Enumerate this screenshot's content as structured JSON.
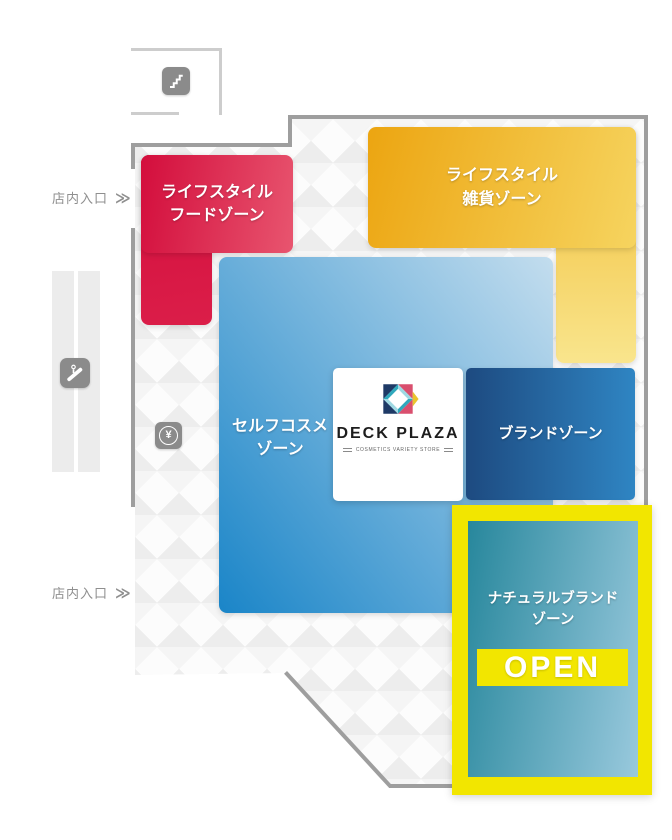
{
  "map": {
    "title_implicit": "DECK PLAZA floor map",
    "colors": {
      "wall": "#9e9e9e",
      "room_outline": "#cdcdcd",
      "highlight_yellow": "#f2e600",
      "food_from": "#d30d3c",
      "food_to": "#e8556f",
      "goods_from": "#eca511",
      "goods_to": "#f9e58d",
      "cosme_from": "#1a85c8",
      "cosme_to": "#c3ddee",
      "brand_from": "#1d4a80",
      "brand_to": "#2f85c3",
      "natural_from": "#27879c",
      "natural_to": "#99c9dd"
    },
    "entrance_top": {
      "label": "店内入口",
      "arrow": "≫"
    },
    "entrance_bottom": {
      "label": "店内入口",
      "arrow": "≫"
    },
    "icons": {
      "stairs": "stairs-icon",
      "escalator": "escalator-icon",
      "cash_register_symbol": "¥"
    },
    "zones": {
      "lifestyle_food": {
        "line1": "ライフスタイル",
        "line2": "フードゾーン"
      },
      "lifestyle_goods": {
        "line1": "ライフスタイル",
        "line2": "雑貨ゾーン"
      },
      "self_cosme": {
        "line1": "セルフコスメ",
        "line2": "ゾーン"
      },
      "brand": {
        "line1": "ブランドゾーン"
      },
      "natural_brand": {
        "line1": "ナチュラルブランド",
        "line2": "ゾーン",
        "badge": "OPEN"
      }
    },
    "store": {
      "name": "DECK PLAZA",
      "tagline": "COSMETICS VARIETY STORE"
    }
  }
}
